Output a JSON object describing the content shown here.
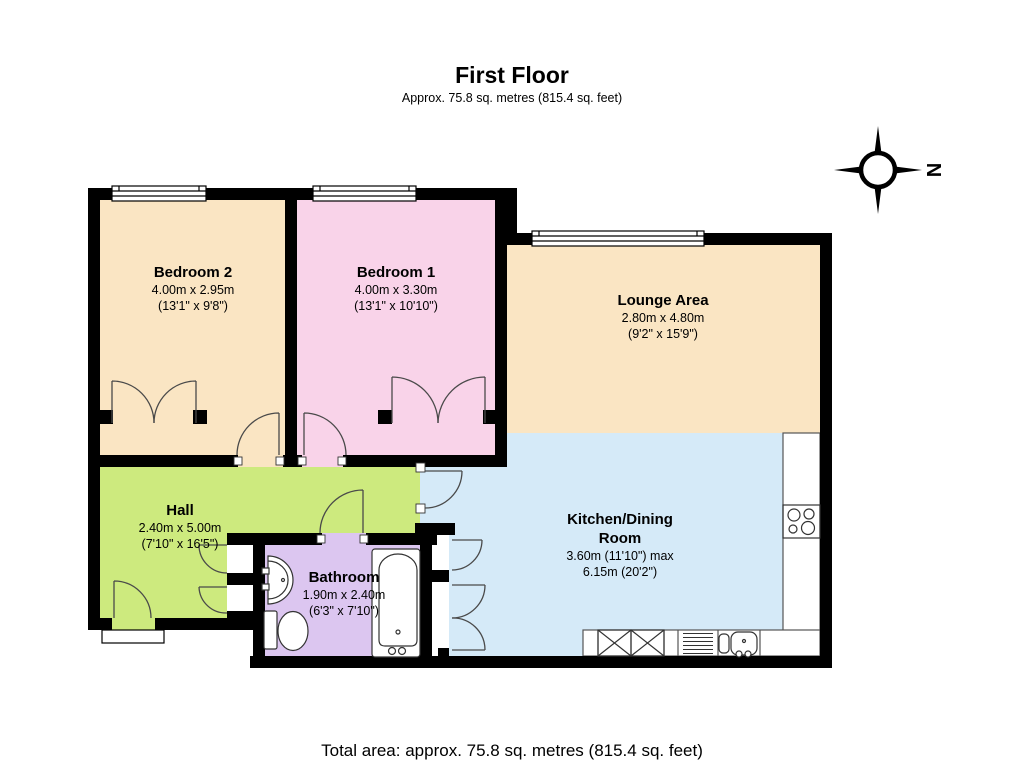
{
  "header": {
    "title": "First Floor",
    "subtitle": "Approx.  75.8 sq. metres (815.4 sq. feet)"
  },
  "footer": {
    "total_area": "Total area: approx.  75.8 sq. metres (815.4 sq. feet)"
  },
  "compass": {
    "north_label": "N"
  },
  "colors": {
    "wall": "#000000",
    "door_stroke": "#4a4a4a",
    "fixture_stroke": "#333333",
    "counter_stroke": "#555555",
    "window_stroke": "#000000",
    "white": "#ffffff"
  },
  "rooms": [
    {
      "name": "Bedroom 2",
      "dim_metric": "4.00m x 2.95m",
      "dim_imperial": "(13'1\" x 9'8\")",
      "color": "#FAE5C3"
    },
    {
      "name": "Bedroom 1",
      "dim_metric": "4.00m x 3.30m",
      "dim_imperial": "(13'1\" x 10'10\")",
      "color": "#F9D3E9"
    },
    {
      "name": "Lounge Area",
      "dim_metric": "2.80m x 4.80m",
      "dim_imperial": "(9'2\" x 15'9\")",
      "color": "#FAE5C3"
    },
    {
      "name": "Kitchen/Dining Room",
      "dim_metric": "3.60m (11'10\") max",
      "dim_imperial": "6.15m (20'2\")",
      "color": "#D5EAF8"
    },
    {
      "name": "Hall",
      "dim_metric": "2.40m x 5.00m",
      "dim_imperial": "(7'10\" x 16'5\")",
      "color": "#CDEA7E"
    },
    {
      "name": "Bathroom",
      "dim_metric": "1.90m x 2.40m",
      "dim_imperial": "(6'3\" x 7'10\")",
      "color": "#DCC6F0"
    }
  ]
}
